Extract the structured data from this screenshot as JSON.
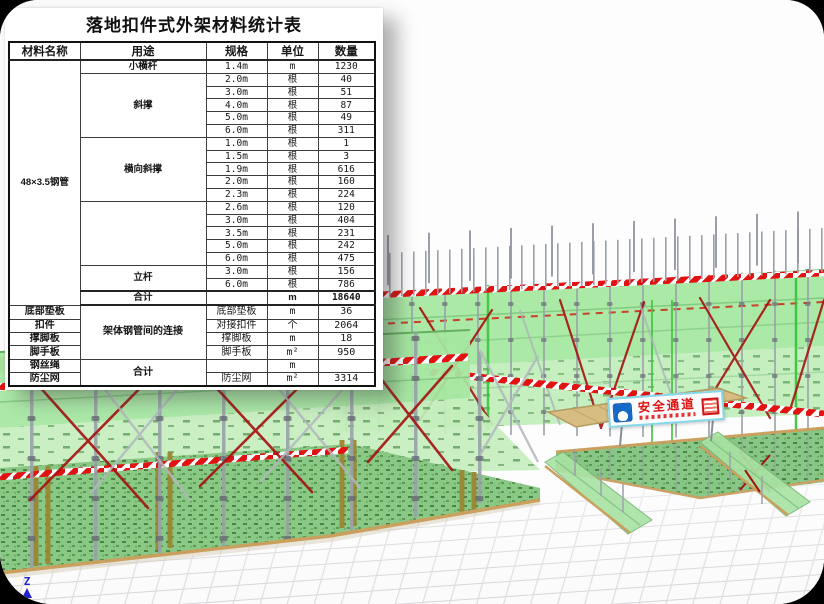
{
  "table": {
    "title": "落地扣件式外架材料统计表",
    "headers": [
      "材料名称",
      "用途",
      "规格",
      "单位",
      "数量"
    ],
    "steel_pipe_material": "48×3.5钢管",
    "groups": [
      {
        "usage": "小横杆",
        "rows": [
          {
            "spec": "1.4m",
            "unit": "m",
            "qty": "1230"
          }
        ]
      },
      {
        "usage": "斜撑",
        "rows": [
          {
            "spec": "2.0m",
            "unit": "根",
            "qty": "40"
          },
          {
            "spec": "3.0m",
            "unit": "根",
            "qty": "51"
          },
          {
            "spec": "4.0m",
            "unit": "根",
            "qty": "87"
          },
          {
            "spec": "5.0m",
            "unit": "根",
            "qty": "49"
          },
          {
            "spec": "6.0m",
            "unit": "根",
            "qty": "311"
          }
        ]
      },
      {
        "usage": "横向斜撑",
        "rows": [
          {
            "spec": "1.0m",
            "unit": "根",
            "qty": "1"
          },
          {
            "spec": "1.5m",
            "unit": "根",
            "qty": "3"
          },
          {
            "spec": "1.9m",
            "unit": "根",
            "qty": "616"
          },
          {
            "spec": "2.0m",
            "unit": "根",
            "qty": "160"
          },
          {
            "spec": "2.3m",
            "unit": "根",
            "qty": "224"
          }
        ]
      },
      {
        "usage": "",
        "rows": [
          {
            "spec": "2.6m",
            "unit": "根",
            "qty": "120"
          },
          {
            "spec": "3.0m",
            "unit": "根",
            "qty": "404"
          },
          {
            "spec": "3.5m",
            "unit": "根",
            "qty": "231"
          },
          {
            "spec": "5.0m",
            "unit": "根",
            "qty": "242"
          },
          {
            "spec": "6.0m",
            "unit": "根",
            "qty": "475"
          }
        ]
      },
      {
        "usage": "立杆",
        "rows": [
          {
            "spec": "3.0m",
            "unit": "根",
            "qty": "156"
          },
          {
            "spec": "6.0m",
            "unit": "根",
            "qty": "786"
          }
        ]
      }
    ],
    "subtotal": {
      "usage": "合计",
      "unit": "m",
      "qty": "18640"
    },
    "bottom_usage_connection": "架体钢管间的连接",
    "bottom_usage_total": "合计",
    "bottom": [
      {
        "material": "底部垫板",
        "spec": "底部垫板",
        "unit": "m",
        "qty": "36"
      },
      {
        "material": "扣件",
        "spec": "对接扣件",
        "unit": "个",
        "qty": "2064"
      },
      {
        "material": "撑脚板",
        "spec": "撑脚板",
        "unit": "m",
        "qty": "18"
      },
      {
        "material": "脚手板",
        "spec": "脚手板",
        "unit": "m²",
        "qty": "950"
      },
      {
        "material": "钢丝绳",
        "spec": "",
        "unit": "m",
        "qty": ""
      },
      {
        "material": "防尘网",
        "spec": "防尘网",
        "unit": "m²",
        "qty": "3314"
      }
    ],
    "colors": {
      "material_text": "#0404e8",
      "usage_text": "#3da03d",
      "total_text": "#2e9a2e"
    }
  },
  "scene": {
    "banner": {
      "text": "安全通道"
    },
    "axis": {
      "label": "Z"
    },
    "colors": {
      "panel_green": "#a4e7a0",
      "mesh_green": "#92d18e",
      "stripe_red": "#e11212",
      "brace_red": "#a51212",
      "trim_tan": "#c9a05e"
    }
  }
}
